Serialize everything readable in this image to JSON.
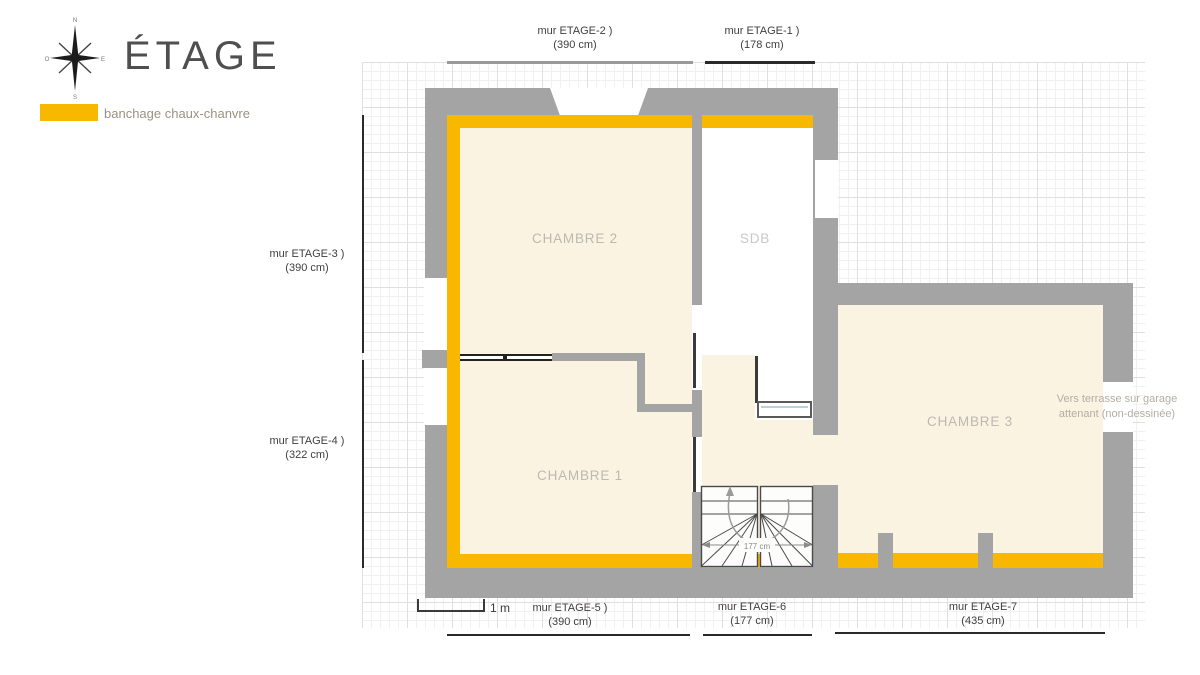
{
  "title": "ÉTAGE",
  "legend": {
    "label": "banchage chaux-chanvre",
    "swatch_color": "#F8B800"
  },
  "compass": {
    "north": "N",
    "south": "S",
    "east": "E",
    "west": "O"
  },
  "scale": {
    "label": "1 m"
  },
  "dims": [
    {
      "id": "mur-etage-2",
      "label": "mur ETAGE-2 )",
      "value": "(390 cm)",
      "side": "top"
    },
    {
      "id": "mur-etage-1",
      "label": "mur ETAGE-1 )",
      "value": "(178 cm)",
      "side": "top"
    },
    {
      "id": "mur-etage-3",
      "label": "mur ETAGE-3 )",
      "value": "(390 cm)",
      "side": "left"
    },
    {
      "id": "mur-etage-4",
      "label": "mur ETAGE-4 )",
      "value": "(322 cm)",
      "side": "left"
    },
    {
      "id": "mur-etage-5",
      "label": "mur ETAGE-5 )",
      "value": "(390 cm)",
      "side": "bottom"
    },
    {
      "id": "mur-etage-6",
      "label": "mur ETAGE-6",
      "value": "(177 cm)",
      "side": "bottom"
    },
    {
      "id": "mur-etage-7",
      "label": "mur ETAGE-7",
      "value": "(435 cm)",
      "side": "bottom"
    }
  ],
  "rooms": [
    {
      "id": "chambre-2",
      "label": "CHAMBRE 2"
    },
    {
      "id": "sdb",
      "label": "SDB"
    },
    {
      "id": "chambre-1",
      "label": "CHAMBRE 1"
    },
    {
      "id": "chambre-3",
      "label": "CHAMBRE 3"
    }
  ],
  "notes": {
    "terrace": "Vers terrasse sur garage attenant (non-dessinée)",
    "stair_width": "177 cm"
  },
  "colors": {
    "banchage_yellow": "#F8B800",
    "wall_gray": "#A4A4A4",
    "floor_cream": "#FAF3E2"
  }
}
